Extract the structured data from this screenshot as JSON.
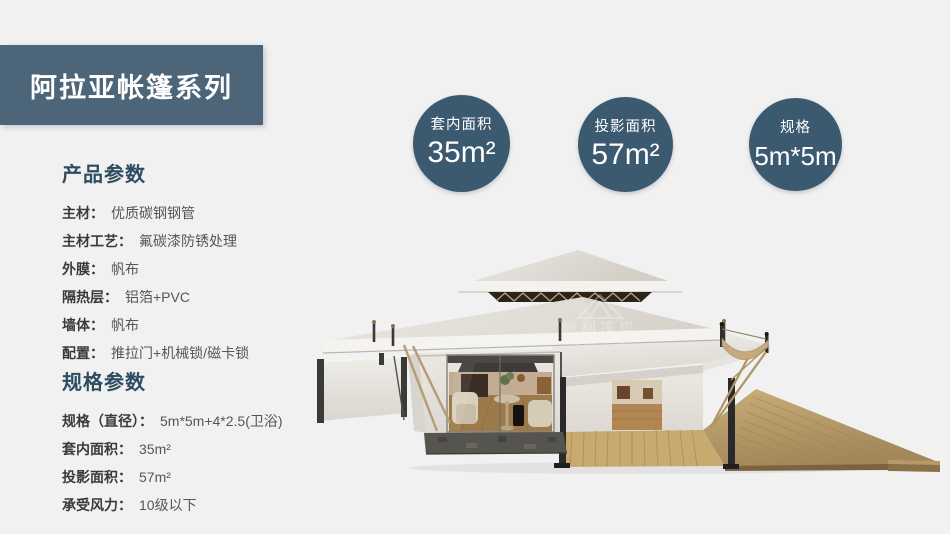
{
  "header": {
    "title": "阿拉亚帐篷系列"
  },
  "badges": [
    {
      "label": "套内面积",
      "value": "35",
      "unit": "m²"
    },
    {
      "label": "投影面积",
      "value": "57",
      "unit": "m²"
    },
    {
      "label": "规格",
      "value": "5m*5m",
      "unit": ""
    }
  ],
  "sections": {
    "product": {
      "title": "产品参数",
      "rows": [
        {
          "label": "主材：",
          "value": "优质碳钢钢管"
        },
        {
          "label": "主材工艺：",
          "value": "氟碳漆防锈处理"
        },
        {
          "label": "外膜：",
          "value": "帆布"
        },
        {
          "label": "隔热层：",
          "value": "铝箔+PVC"
        },
        {
          "label": "墙体：",
          "value": "帆布"
        },
        {
          "label": "配置：",
          "value": "推拉门+机械锁/磁卡锁"
        }
      ]
    },
    "spec": {
      "title": "规格参数",
      "rows": [
        {
          "label": "规格（直径）：",
          "value": "5m*5m+4*2.5(卫浴)"
        },
        {
          "label": "套内面积：",
          "value": "35m²"
        },
        {
          "label": "投影面积：",
          "value": "57m²"
        },
        {
          "label": "承受风力：",
          "value": "10级以下"
        }
      ]
    }
  },
  "illustration": {
    "watermark_cn": "帐利篷房",
    "watermark_en": "WELL TENT"
  },
  "colors": {
    "banner": "#4c6578",
    "badge": "#3b5a70",
    "section_title": "#2e4d61",
    "deck_wood": "#b29260",
    "canvas_roof": "#ddd9d2"
  }
}
